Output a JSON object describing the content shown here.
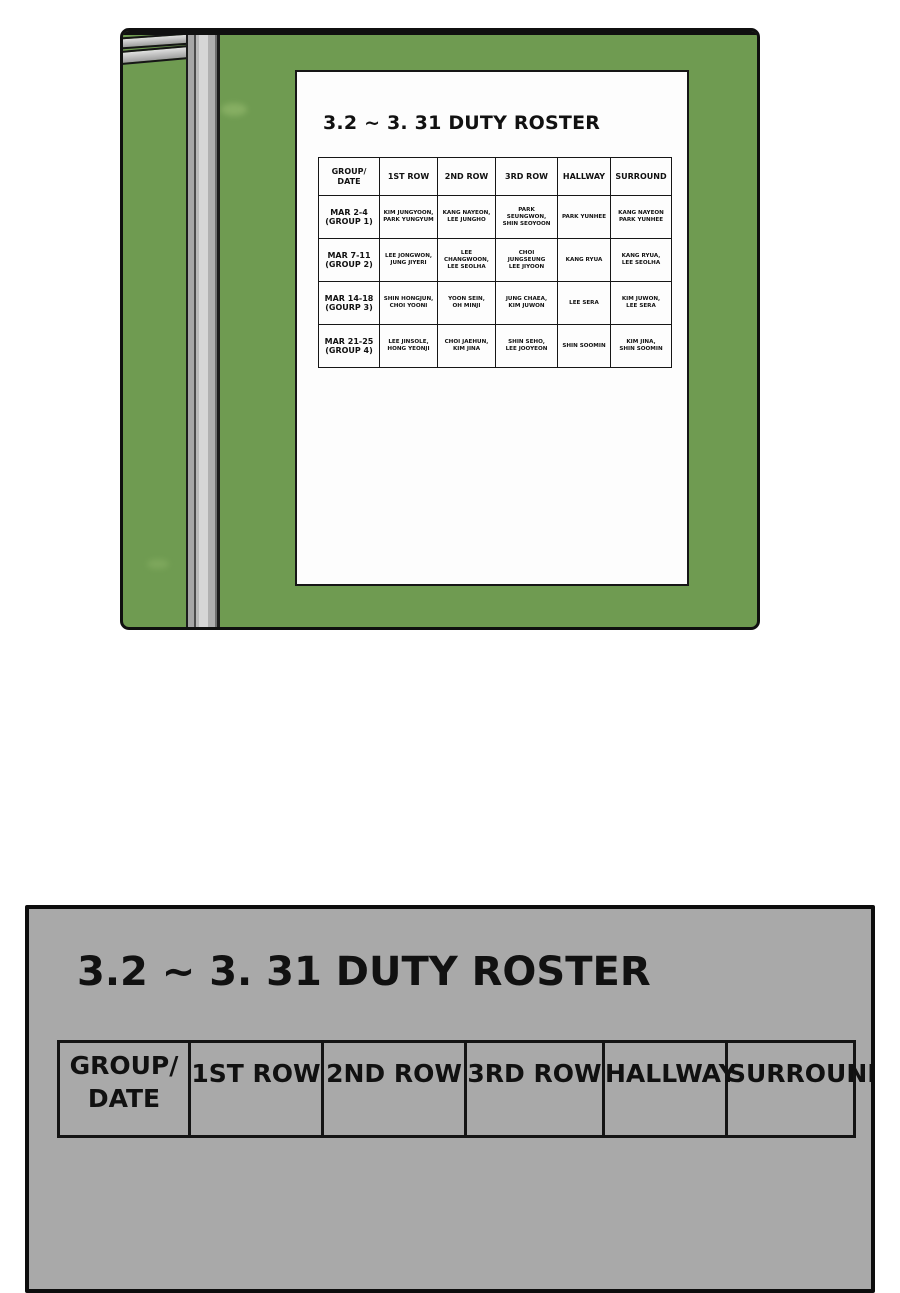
{
  "board_panel": {
    "paper": {
      "title": "3.2 ~ 3. 31 DUTY ROSTER",
      "table": {
        "headers": [
          "GROUP/\nDATE",
          "1ST ROW",
          "2ND ROW",
          "3RD ROW",
          "HALLWAY",
          "SURROUND"
        ],
        "rows": [
          {
            "label": "MAR 2-4\n(GROUP 1)",
            "cells": [
              "KIM JUNGYOON,\nPARK YUNGYUM",
              "KANG NAYEON,\nLEE JUNGHO",
              "PARK\nSEUNGWON,\nSHIN SEOYOON",
              "PARK YUNHEE",
              "KANG NAYEON\nPARK YUNHEE"
            ]
          },
          {
            "label": "MAR 7-11\n(GROUP 2)",
            "cells": [
              "LEE JONGWON,\nJUNG JIYERI",
              "LEE CHANGWOON,\nLEE SEOLHA",
              "CHOI\nJUNGSEUNG\nLEE JIYOON",
              "KANG RYUA",
              "KANG RYUA,\nLEE SEOLHA"
            ]
          },
          {
            "label": "MAR 14-18\n(GOURP 3)",
            "cells": [
              "SHIN HONGJUN,\nCHOI YOONI",
              "YOON SEIN,\nOH MINJI",
              "JUNG CHAEA,\nKIM JUWON",
              "LEE SERA",
              "KIM JUWON,\nLEE SERA"
            ]
          },
          {
            "label": "MAR 21-25\n(GROUP 4)",
            "cells": [
              "LEE JINSOLE,\nHONG YEONJI",
              "CHOI JAEHUN,\nKIM JINA",
              "SHIN SEHO,\nLEE JOOYEON",
              "SHIN SOOMIN",
              "KIM JINA,\nSHIN SOOMIN"
            ]
          }
        ]
      }
    }
  },
  "zoom_panel": {
    "title": "3.2 ~ 3. 31 DUTY ROSTER",
    "headers": [
      "GROUP/\nDATE",
      "1ST ROW",
      "2ND ROW",
      "3RD ROW",
      "HALLWAY",
      "SURROUND"
    ]
  },
  "colors": {
    "board_green": "#6f9b51",
    "frame_gray": "#c6c6c6",
    "panel_gray": "#a9a9a9",
    "paper_white": "#fdfdfd",
    "line_black": "#161616"
  }
}
